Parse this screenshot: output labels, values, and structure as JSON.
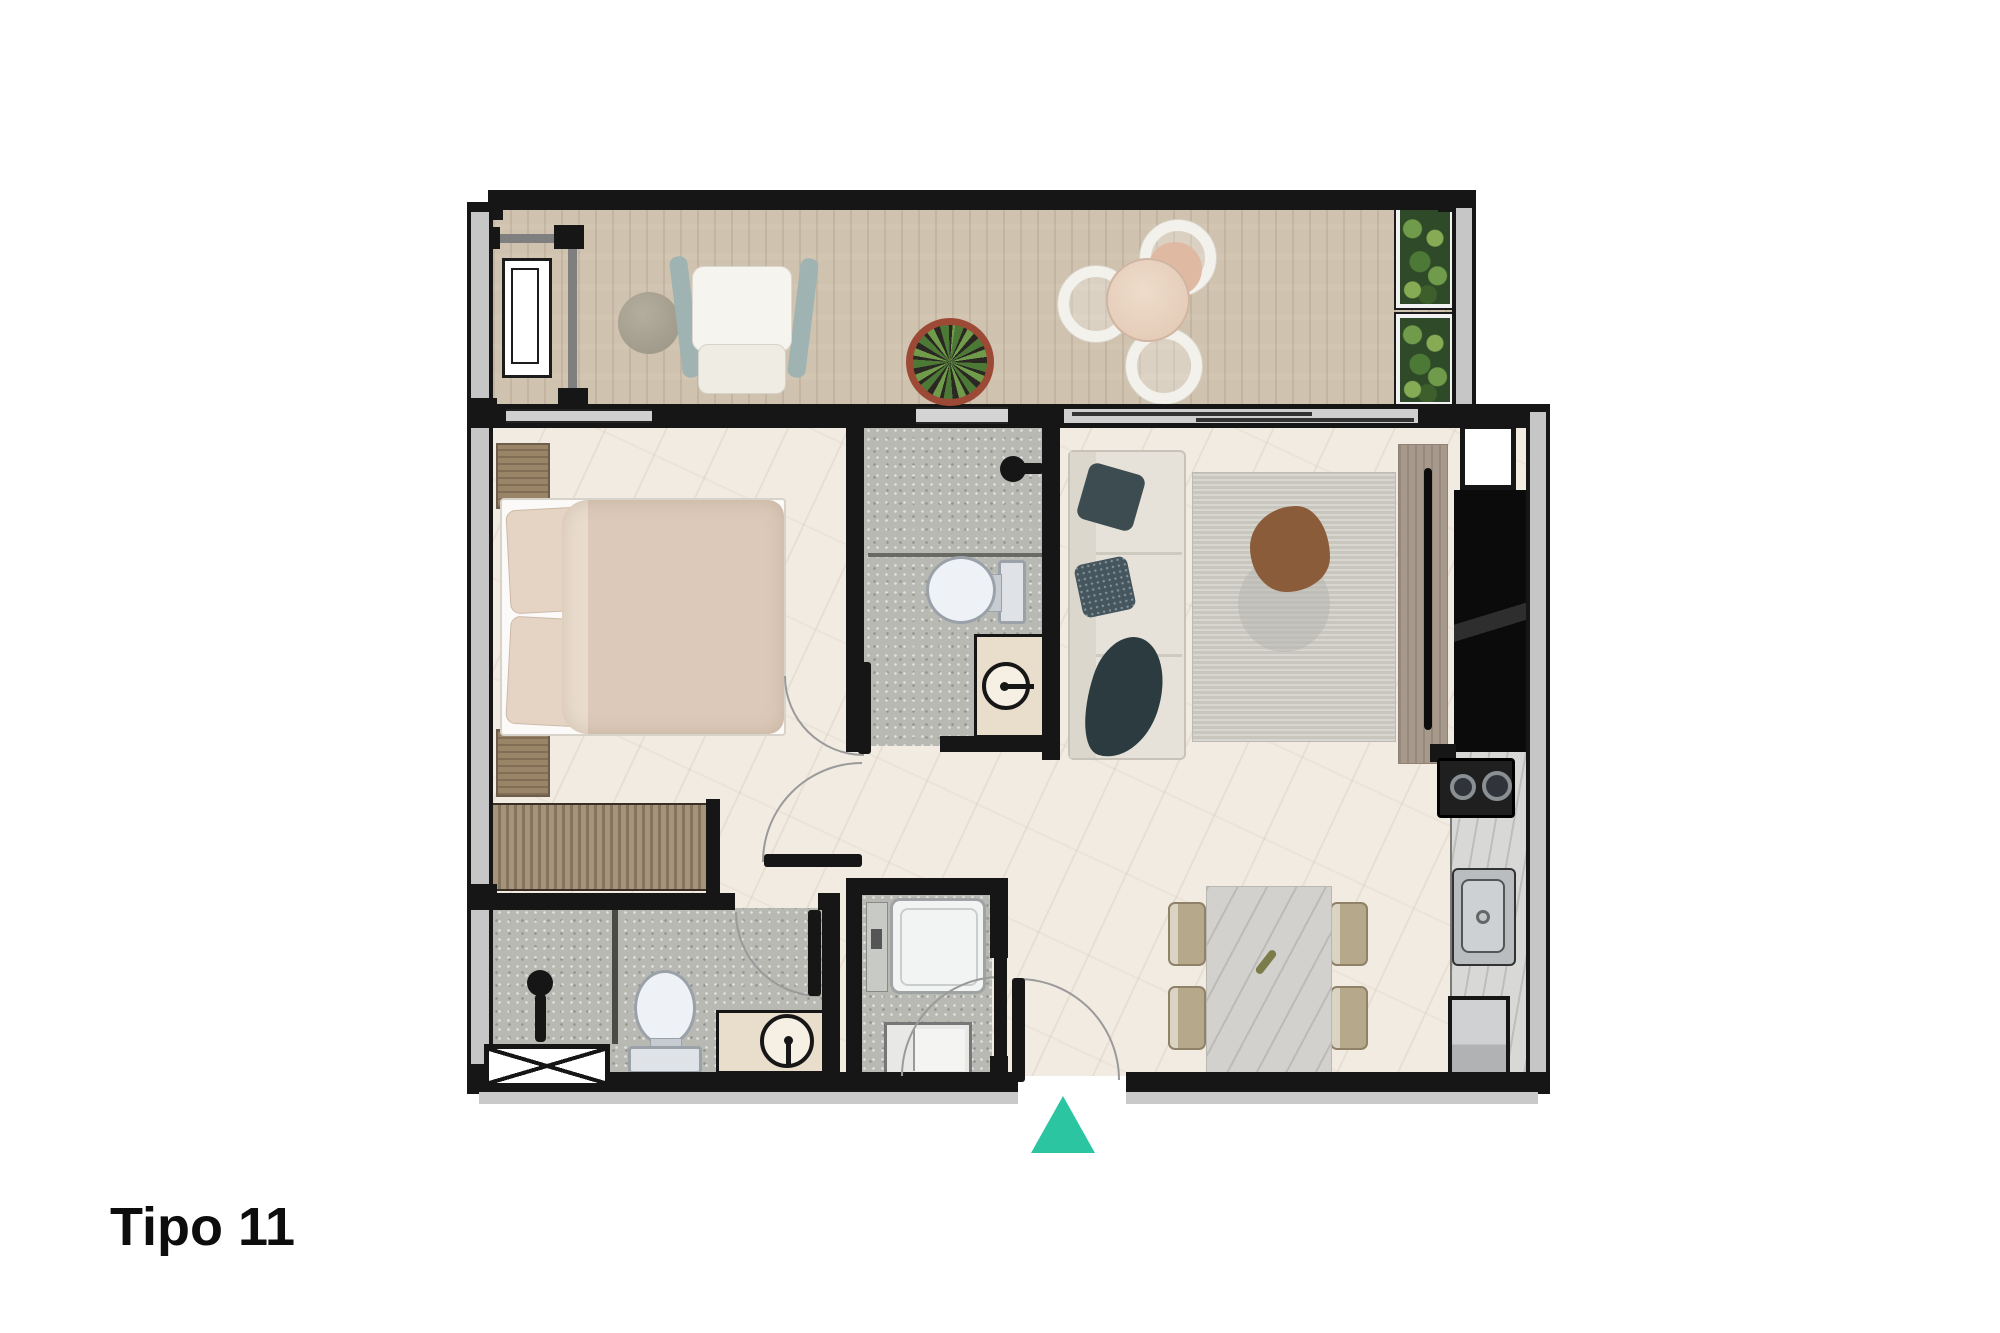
{
  "title": "Tipo 11",
  "colors": {
    "accent": "#2cc5a2",
    "wall": "#161616",
    "wood_floor": "#cfc2ae",
    "marble_floor": "#f1ebe2",
    "tile_floor": "#b8b9b3",
    "counter": "#d8d8d6",
    "wood_furniture": "#9a8468",
    "sofa": "#e6e2da",
    "pillow_dark": "#3c4c50",
    "rug": "#c9c6be",
    "rug_accent": "#8a5c39",
    "bed_linen": "#dcc9b9",
    "chair_tan": "#b6a88a"
  },
  "icons": {
    "entrance-marker": "css-triangle-up",
    "bed": "top-view-double-bed",
    "sofa": "top-view-sofa",
    "toilet": "top-view-toilet",
    "shower-head": "circle-with-stem",
    "round-sink": "outlined-circle-with-faucet",
    "stove": "two-burner-cooktop",
    "kitchen-sink": "steel-basin-with-drain",
    "fridge": "gray-box",
    "washer": "white-rounded-box",
    "planter": "green-foliage-box",
    "potted-plant": "radial-leaf-plant",
    "crossed-box": "rectangle-with-x",
    "door-swing": "quarter-arc-with-leaf"
  }
}
